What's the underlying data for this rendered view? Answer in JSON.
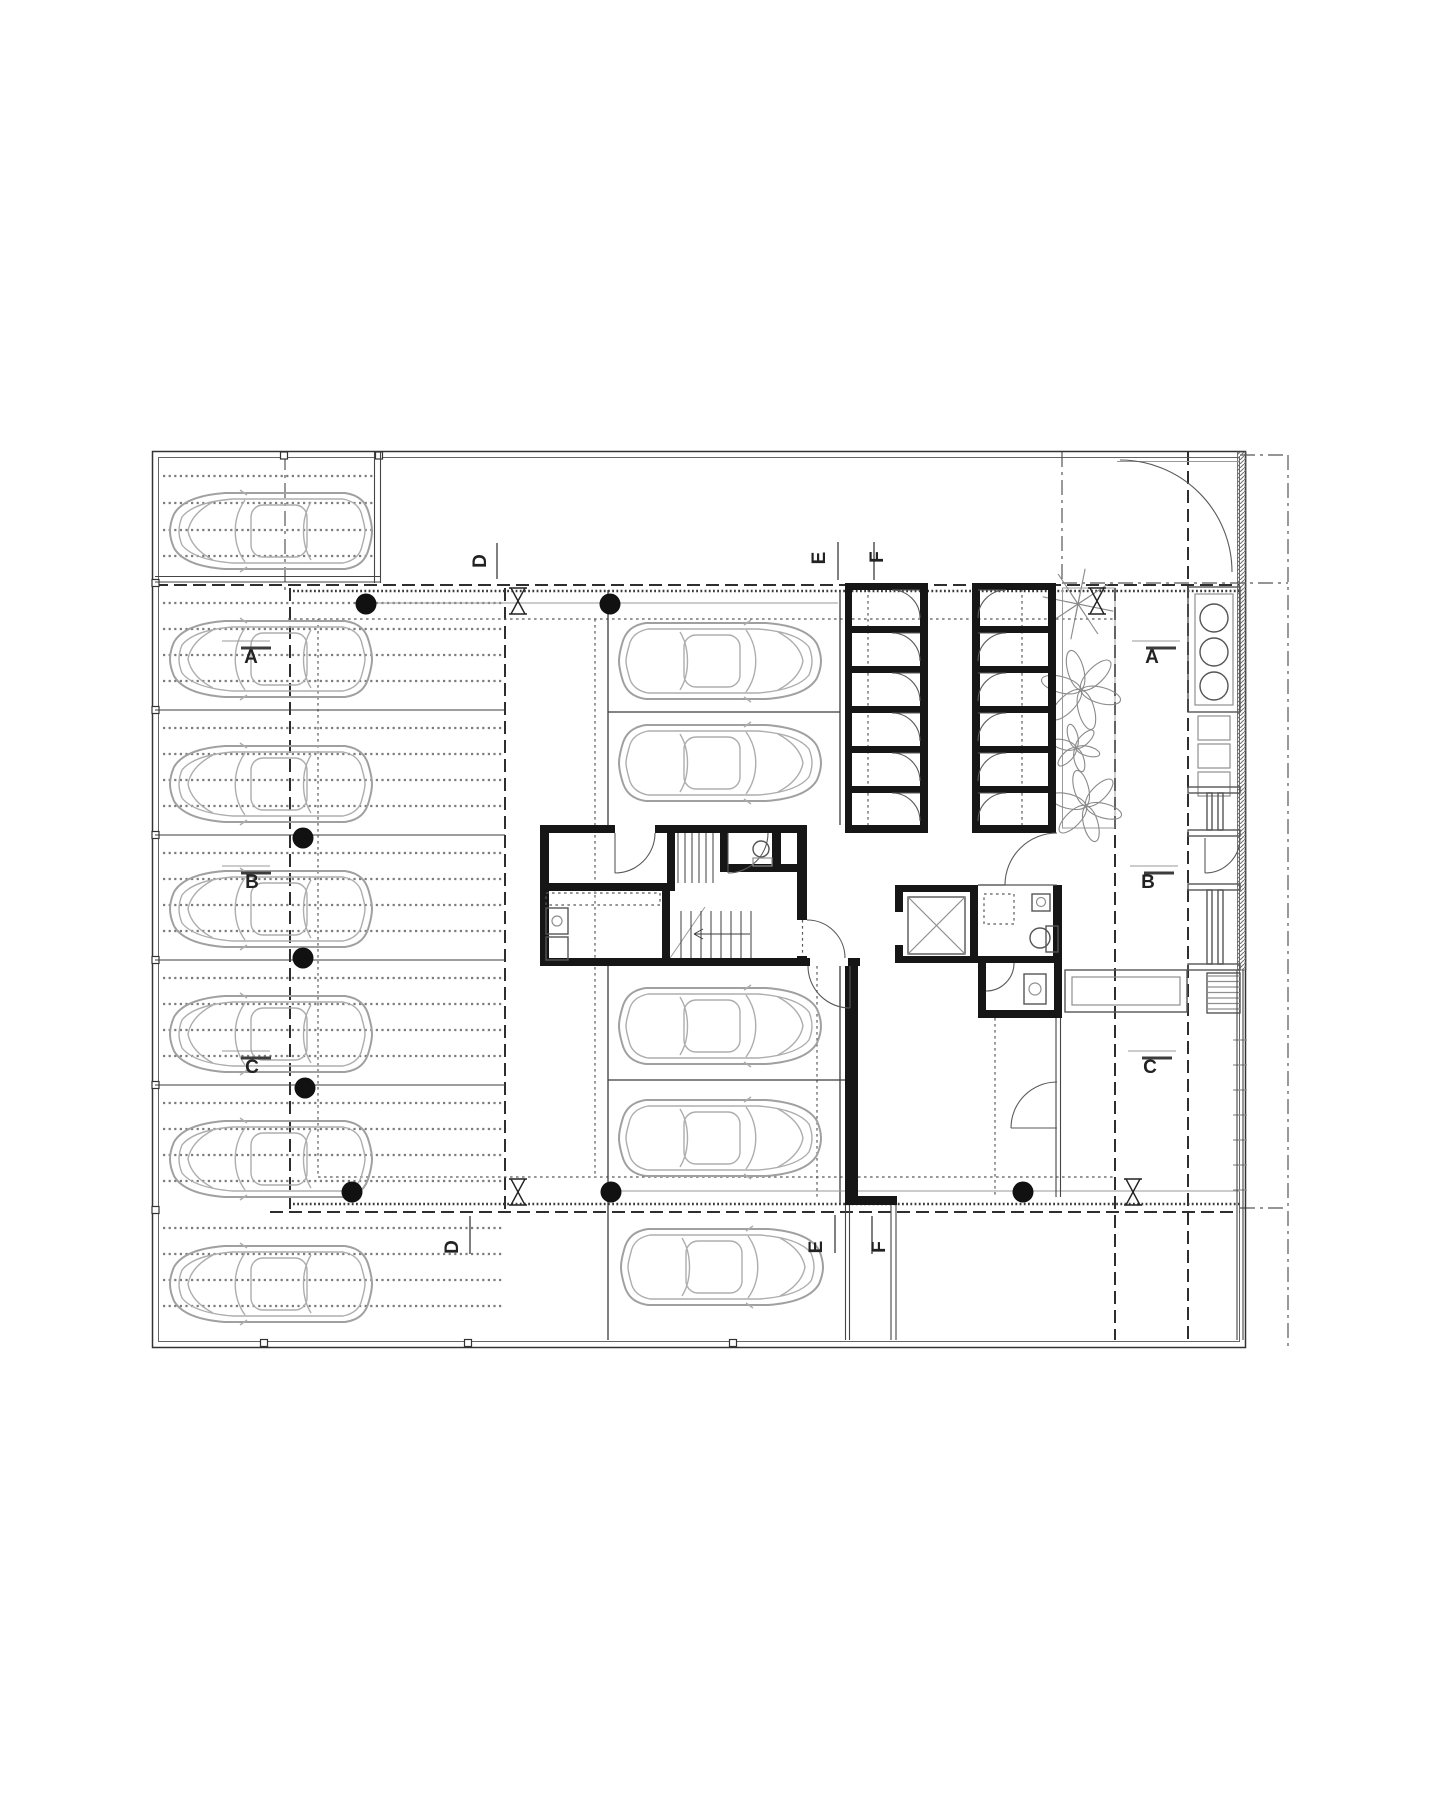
{
  "page": {
    "background": "#ffffff",
    "kind": "architectural floor plan, ground / parking level"
  },
  "colors": {
    "wall": "#161616",
    "thin_line": "#3c3c3c",
    "car_line": "#a8a8a8",
    "lobby_fill": "#e8e8e8",
    "hatch_line": "#bdbdbd",
    "text": "#222222"
  },
  "section_markers": [
    {
      "letter": "A",
      "x": 251,
      "y": 663,
      "rot": 0,
      "thin": [
        222,
        641,
        270,
        641
      ],
      "thick": [
        241,
        648,
        271,
        648
      ]
    },
    {
      "letter": "A",
      "x": 1152,
      "y": 663,
      "rot": 0,
      "thin": [
        1132,
        641,
        1180,
        641
      ],
      "thick": [
        1146,
        648,
        1176,
        648
      ]
    },
    {
      "letter": "B",
      "x": 252,
      "y": 888,
      "rot": 0,
      "thin": [
        222,
        866,
        270,
        866
      ],
      "thick": [
        241,
        873,
        271,
        873
      ]
    },
    {
      "letter": "B",
      "x": 1148,
      "y": 888,
      "rot": 0,
      "thin": [
        1130,
        866,
        1178,
        866
      ],
      "thick": [
        1144,
        873,
        1174,
        873
      ]
    },
    {
      "letter": "C",
      "x": 252,
      "y": 1073,
      "rot": 0,
      "thin": [
        222,
        1051,
        270,
        1051
      ],
      "thick": [
        241,
        1058,
        271,
        1058
      ]
    },
    {
      "letter": "C",
      "x": 1150,
      "y": 1073,
      "rot": 0,
      "thin": [
        1128,
        1051,
        1176,
        1051
      ],
      "thick": [
        1142,
        1058,
        1172,
        1058
      ]
    },
    {
      "letter": "D",
      "x": 486,
      "y": 561,
      "rot": -90,
      "line": [
        497,
        543,
        497,
        579
      ]
    },
    {
      "letter": "D",
      "x": 458,
      "y": 1247,
      "rot": -90,
      "line": [
        470,
        1216,
        470,
        1254
      ]
    },
    {
      "letter": "E",
      "x": 825,
      "y": 558,
      "rot": -90,
      "line": [
        838,
        542,
        838,
        580
      ]
    },
    {
      "letter": "F",
      "x": 883,
      "y": 557,
      "rot": -90,
      "line": [
        874,
        542,
        874,
        580
      ]
    },
    {
      "letter": "E",
      "x": 822,
      "y": 1247,
      "rot": -90,
      "line": [
        835,
        1215,
        835,
        1253
      ]
    },
    {
      "letter": "F",
      "x": 885,
      "y": 1247,
      "rot": -90,
      "line": [
        872,
        1216,
        872,
        1254
      ]
    }
  ],
  "plan": {
    "border": {
      "outer": [
        152.5,
        451.5,
        1093,
        896
      ],
      "inner": [
        158.5,
        457.5,
        1081,
        884
      ]
    },
    "border_squares": {
      "top_x": [
        284,
        379
      ],
      "left_y": [
        583,
        710,
        835,
        960,
        1085,
        1210
      ],
      "bottom_x": [
        264,
        468,
        733
      ]
    },
    "cars": {
      "left": {
        "x": 167,
        "tops": [
          490,
          618,
          743,
          868,
          993,
          1118,
          1243
        ],
        "facing": "left"
      },
      "middle": {
        "x": 618,
        "tops": [
          620,
          722,
          985,
          1097
        ],
        "facing": "right"
      },
      "strip": {
        "x": 620,
        "tops": [
          1226
        ],
        "facing": "right"
      }
    },
    "bays": {
      "left_dividers_y": [
        710,
        835,
        960,
        1085
      ],
      "bay_tops": [
        585,
        710,
        835,
        960,
        1085,
        1210
      ],
      "dotted_offsets": [
        18,
        44,
        70,
        96
      ],
      "bay1_dotted_y": [
        476,
        503,
        530,
        556
      ],
      "dotted_x": [
        163,
        502
      ],
      "bay1_dotted_x": [
        163,
        374
      ]
    },
    "lines": {
      "ln": [
        [
          608,
          590,
          608,
          825
        ],
        [
          608,
          966,
          608,
          1340
        ],
        [
          840,
          590,
          840,
          825
        ],
        [
          840,
          966,
          840,
          1205
        ],
        [
          608,
          712,
          840,
          712
        ],
        [
          608,
          1080,
          845,
          1080
        ],
        [
          978,
          885,
          1053,
          885
        ]
      ],
      "lt": [
        [
          366,
          603,
          838,
          603
        ],
        [
          608,
          1191,
          1240,
          1191
        ],
        [
          668,
          961,
          705,
          907
        ],
        [
          1117,
          461.5,
          1239,
          461.5
        ]
      ],
      "dbl": [
        [
          374.5,
          452,
          374.5,
          583
        ],
        [
          380.5,
          452,
          380.5,
          583
        ],
        [
          155,
          576.5,
          381,
          576.5
        ],
        [
          155,
          582,
          381,
          582
        ],
        [
          1056,
          1018,
          1056,
          1197
        ],
        [
          1060.5,
          1018,
          1060.5,
          1197
        ],
        [
          845.5,
          1205,
          845.5,
          1340
        ],
        [
          849.5,
          1205,
          849.5,
          1340
        ],
        [
          891,
          1205,
          891,
          1340
        ],
        [
          896,
          1205,
          896,
          1340
        ],
        [
          1237,
          970,
          1237,
          1340
        ],
        [
          1243,
          970,
          1243,
          1340
        ]
      ],
      "hdash": [
        [
          155,
          585,
          1240,
          585
        ],
        [
          270,
          1212,
          1240,
          1212
        ],
        [
          290,
          588,
          290,
          1210
        ],
        [
          505,
          588,
          505,
          1210
        ],
        [
          1115,
          588,
          1115,
          1340
        ],
        [
          1188,
          452,
          1188,
          1340
        ]
      ],
      "ddot": [
        [
          288,
          619,
          1115,
          619
        ],
        [
          318,
          1177,
          1115,
          1177
        ],
        [
          318,
          619,
          318,
          1177
        ],
        [
          595,
          619,
          595,
          1177
        ],
        [
          868,
          583,
          868,
          833
        ],
        [
          1022,
          583,
          1022,
          833
        ],
        [
          817,
          966,
          817,
          1200
        ],
        [
          995,
          1018,
          995,
          1198
        ],
        [
          802.5,
          920,
          802.5,
          958
        ]
      ],
      "dd": [
        [
          1288,
          455,
          1288,
          1348
        ],
        [
          1062,
          452,
          1062,
          583
        ],
        [
          1062,
          583,
          1288,
          583
        ],
        [
          1240,
          1208,
          1288,
          1208
        ],
        [
          1240,
          455,
          1288,
          455
        ],
        [
          285,
          455,
          285,
          590
        ]
      ],
      "serr": [
        [
          293,
          591,
          1240,
          591
        ],
        [
          293,
          1204,
          1240,
          1204
        ]
      ]
    },
    "walls": [
      [
        540,
        825,
        75,
        8
      ],
      [
        655,
        825,
        152,
        8
      ],
      [
        845,
        825,
        83,
        8
      ],
      [
        972,
        825,
        84,
        8
      ],
      [
        540,
        825,
        9,
        141
      ],
      [
        540,
        883,
        135,
        8
      ],
      [
        662,
        891,
        8,
        75
      ],
      [
        667,
        825,
        8,
        60
      ],
      [
        720,
        825,
        8,
        45
      ],
      [
        772,
        825,
        9,
        45
      ],
      [
        720,
        864,
        87,
        8
      ],
      [
        797,
        825,
        10,
        95
      ],
      [
        797,
        956,
        10,
        10
      ],
      [
        540,
        958,
        270,
        8
      ],
      [
        848,
        958,
        12,
        8
      ],
      [
        845,
        966,
        13,
        232
      ],
      [
        845,
        1196,
        52,
        9
      ],
      [
        845,
        583,
        7,
        250
      ],
      [
        845,
        583,
        83,
        7
      ],
      [
        972,
        583,
        84,
        7
      ],
      [
        920,
        590,
        8,
        235
      ],
      [
        972,
        590,
        8,
        235
      ],
      [
        1048,
        583,
        8,
        250
      ],
      [
        895,
        885,
        8,
        27
      ],
      [
        895,
        945,
        8,
        18
      ],
      [
        970,
        885,
        8,
        78
      ],
      [
        895,
        885,
        83,
        7
      ],
      [
        895,
        956,
        167,
        7
      ],
      [
        1053,
        885,
        9,
        78
      ],
      [
        978,
        963,
        8,
        47
      ],
      [
        978,
        1010,
        84,
        8
      ],
      [
        1054,
        963,
        8,
        55
      ]
    ],
    "doors": [
      {
        "d": "M655,833 A40,40 0 0 1 615,873",
        "leaf": [
          615,
          833,
          615,
          873
        ]
      },
      {
        "d": "M768,833 A40,40 0 0 1 728,873",
        "leaf": [
          728,
          833,
          728,
          873
        ]
      },
      {
        "d": "M807,920 A38,38 0 0 1 845,958",
        "leaf": null
      },
      {
        "d": "M808,966 A42,42 0 0 0 850,1008",
        "leaf": [
          850,
          966,
          850,
          1008
        ]
      },
      {
        "d": "M1057,833 A52,52 0 0 0 1005,885",
        "leaf": [
          1057,
          885,
          1005,
          885
        ]
      },
      {
        "d": "M1057,1082 A46,46 0 0 0 1011,1128",
        "leaf": [
          1057,
          1128,
          1011,
          1128
        ]
      },
      {
        "d": "M986,991 A28,28 0 0 0 1014,963",
        "leaf": null
      },
      {
        "d": "M1120,460 A112,112 0 0 1 1232,572",
        "leaf": null
      },
      {
        "d": "M1240,838 A35,35 0 0 1 1205,873",
        "leaf": [
          1205,
          838,
          1205,
          873
        ]
      }
    ],
    "storage": {
      "cell_tops": [
        590,
        633,
        673,
        713,
        753,
        793
      ],
      "divider_y": [
        626,
        666,
        706,
        746,
        786
      ],
      "left_col": {
        "x": 852,
        "w": 68,
        "hinge_x": 920,
        "dir": -1
      },
      "right_col": {
        "x": 980,
        "w": 68,
        "hinge_x": 978,
        "dir": 1
      },
      "door_r": 28
    },
    "stairs": {
      "upper_treads_x": [
        678,
        685,
        692,
        699,
        706,
        713
      ],
      "upper_y": [
        833,
        883
      ],
      "lower_treads_x": [
        681,
        691,
        701,
        711,
        721,
        731,
        741,
        751
      ],
      "lower_y": [
        911,
        958
      ],
      "arrow": [
        750,
        934,
        694,
        934
      ]
    },
    "elevator": {
      "cab": [
        908,
        897,
        57,
        57
      ]
    },
    "planter": {
      "rect": [
        1062.5,
        588,
        52.5,
        240
      ],
      "flowers": [
        {
          "type": "star",
          "x": 1078,
          "y": 604,
          "r": 36
        },
        {
          "type": "daisy",
          "x": 1081,
          "y": 690,
          "r": 40
        },
        {
          "type": "daisy",
          "x": 1076,
          "y": 748,
          "r": 24
        },
        {
          "type": "daisy",
          "x": 1086,
          "y": 806,
          "r": 36
        }
      ],
      "dots": [
        [
          1068,
          620
        ],
        [
          1100,
          598
        ],
        [
          1072,
          640
        ],
        [
          1092,
          632
        ],
        [
          1104,
          650
        ],
        [
          1070,
          664
        ],
        [
          1096,
          668
        ],
        [
          1108,
          678
        ],
        [
          1073,
          700
        ],
        [
          1101,
          706
        ],
        [
          1069,
          718
        ],
        [
          1088,
          722
        ],
        [
          1106,
          730
        ],
        [
          1071,
          742
        ],
        [
          1098,
          752
        ],
        [
          1108,
          762
        ],
        [
          1074,
          770
        ],
        [
          1090,
          778
        ],
        [
          1104,
          788
        ],
        [
          1068,
          792
        ],
        [
          1080,
          820
        ],
        [
          1096,
          816
        ],
        [
          1066,
          806
        ],
        [
          1102,
          798
        ],
        [
          1076,
          606
        ],
        [
          1094,
          614
        ]
      ]
    },
    "bins": {
      "outer": [
        1188,
        587,
        52,
        125
      ],
      "inner": [
        1195,
        594,
        38,
        111
      ],
      "cx": 1214,
      "cys": [
        618,
        652,
        686
      ],
      "r": 14
    },
    "lockers": [
      [
        1198,
        716,
        32,
        24
      ],
      [
        1198,
        744,
        32,
        24
      ],
      [
        1198,
        772,
        32,
        24
      ]
    ],
    "door_frames": [
      {
        "walls": [
          [
            1188,
            787,
            52,
            6
          ],
          [
            1188,
            830,
            52,
            6
          ]
        ],
        "jambs": [
          [
            1207,
            793,
            5,
            37
          ],
          [
            1218,
            793,
            5,
            37
          ]
        ]
      },
      {
        "walls": [
          [
            1188,
            884,
            52,
            6
          ],
          [
            1188,
            964,
            52,
            6
          ]
        ],
        "jambs": [
          [
            1207,
            890,
            5,
            74
          ],
          [
            1218,
            890,
            5,
            74
          ]
        ]
      }
    ],
    "bench": {
      "outer": [
        1065,
        970,
        122,
        42
      ],
      "inner": [
        1072,
        977,
        108,
        28
      ]
    },
    "steps": {
      "frame": [
        1207,
        973,
        33,
        40
      ],
      "tread_ys": [
        976,
        981.5,
        987,
        992.5,
        998,
        1003.5,
        1009
      ],
      "x": [
        1207,
        1240
      ]
    },
    "fence_tick_ys": [
      1040,
      1065,
      1090,
      1115,
      1140,
      1165,
      1190
    ],
    "column_dots": [
      [
        366,
        604
      ],
      [
        610,
        604
      ],
      [
        303,
        838
      ],
      [
        303,
        958
      ],
      [
        305,
        1088
      ],
      [
        352,
        1192
      ],
      [
        611,
        1192
      ],
      [
        1023,
        1192
      ]
    ],
    "column_ties": [
      [
        518,
        601
      ],
      [
        1097,
        601
      ],
      [
        518,
        1192
      ],
      [
        1133,
        1192
      ]
    ],
    "fills": {
      "lobby_path": "M807,833 L1053,833 L1053,885 L895,885 L895,958 L807,958 Z",
      "bathroom": [
        978,
        885,
        75,
        73
      ],
      "closet": [
        986,
        963,
        68,
        47
      ]
    },
    "fixtures": {
      "wc_sink": {
        "c": [
          761,
          849,
          8
        ],
        "shelf": [
          753,
          858,
          19,
          8
        ]
      },
      "kitchen": {
        "counter_dash": [
          546,
          893,
          114,
          12
        ],
        "units": [
          [
            546,
            908,
            22,
            26
          ],
          [
            546,
            937,
            22,
            23
          ]
        ],
        "sink_c": [
          557,
          921,
          5
        ]
      },
      "bath": {
        "toilet_c": [
          1040,
          938,
          10
        ],
        "tank": [
          1046,
          926,
          12,
          26
        ],
        "sink": [
          1032,
          894,
          18,
          17
        ],
        "sink_c": [
          1041,
          902,
          4.5
        ],
        "shower_dash": [
          984,
          894,
          30,
          30
        ]
      },
      "closet_unit": {
        "rect": [
          1024,
          974,
          22,
          30
        ],
        "c": [
          1035,
          989,
          6
        ]
      }
    },
    "hatch_wall": [
      1237.5,
      452,
      8.5,
      518
    ]
  }
}
